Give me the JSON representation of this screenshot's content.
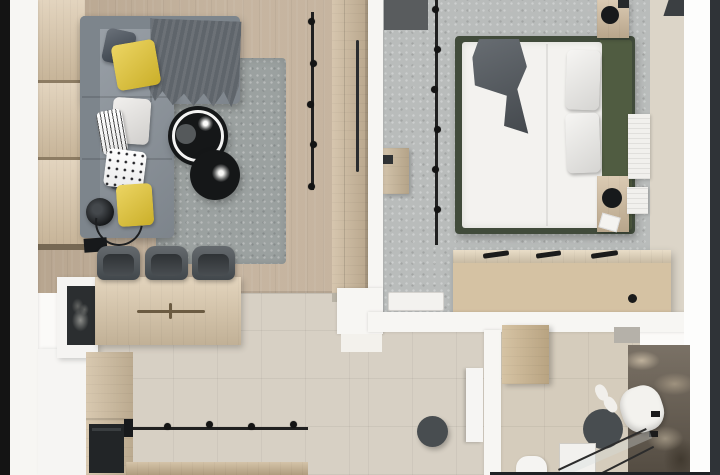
{
  "scene": {
    "kind": "apartment-interior-top-view-3d-render",
    "view": "top-down",
    "canvas": {
      "width": 720,
      "height": 475
    },
    "rooms": [
      {
        "id": "living-room",
        "floor": "light-oak-plank",
        "items": [
          "wood-slat-accent-wall",
          "corner-sofa",
          "throw-blanket",
          "area-rug",
          "coffee-table-pair",
          "floor-lamp",
          "ceiling-track-light",
          "wardrobe"
        ]
      },
      {
        "id": "bedroom",
        "floor": "gray-carpet",
        "items": [
          "double-bed",
          "green-headboard",
          "gray-blanket",
          "nightstand-pair",
          "table-lamps",
          "radiator",
          "wall-bench",
          "dresser",
          "ceiling-track-light"
        ]
      },
      {
        "id": "kitchen-dining",
        "floor": "beige-tile",
        "items": [
          "wall-desk",
          "office-chairs",
          "media-sideboard",
          "tall-cabinet",
          "oven",
          "counter",
          "ceiling-track-light"
        ]
      },
      {
        "id": "hallway",
        "floor": "beige-tile",
        "items": [
          "round-pouf",
          "wall-shelf"
        ]
      },
      {
        "id": "bathroom",
        "floor": "beige-tile",
        "items": [
          "floral-accent-wall",
          "open-wood-door",
          "shower-glass",
          "toilet",
          "round-rug",
          "towel",
          "slippers",
          "wall-hooks"
        ]
      }
    ],
    "counts": {
      "sofa_pillows": 7,
      "office_chairs": 3,
      "coffee_tables": 2,
      "nightstands": 2,
      "track_lights": 3,
      "dresser_handles": 3,
      "radiator_panels": 2
    }
  },
  "palette": {
    "frame_left": "#141414",
    "frame_right": "#2f3337",
    "wall": "#f7f6f3",
    "wall_bright": "#fdfdfc",
    "threshold": "#f3f1ec",
    "wood_floor": "#c2b09a",
    "wood_panel": "#d8c4a6",
    "panel_gap": "#8d7c63",
    "wardrobe": "#cdb99c",
    "wardrobe_base": "#b9b3a6",
    "sofa": "#8b939b",
    "sofa_dark": "#7d858c",
    "throw": "#5f656b",
    "pillow_yellow": "#e6c72f",
    "pillow_navy": "#39424d",
    "pillow_white": "#edebe8",
    "rug": "#9ba1a0",
    "table_black": "#151718",
    "ring_white": "#f4f4f3",
    "decor_gray": "#55595b",
    "lamp_black": "#17191b",
    "carpet": "#b9bcbb",
    "carpet_mat": "#595c5e",
    "bed_frame": "#414b3b",
    "headboard": "#505c41",
    "bedding": "#f3f2ef",
    "blanket": "#565c62",
    "nightstand": "#d1bc9e",
    "radiator": "#f1f0ed",
    "tv_dark": "#3b3f42",
    "dresser_top": "#e3d4b9",
    "dresser_front": "#d5c2a3",
    "handle_black": "#1b1b1b",
    "bedroom_wall": "#dcd5c8",
    "tile": "#d7d0c4",
    "bath_tile": "#d5ccbc",
    "pouf": "#484d50",
    "shelf_white": "#f6f5f3",
    "floral_wall": "#6b6154",
    "door_wood": "#cdb690",
    "toilet_white": "#f5f4f2",
    "towel_white": "#f3f2ee",
    "glass_line": "#2c2c2c",
    "column_white": "#f6f5f3",
    "sideboard_white": "#f5f4f2",
    "art_dark": "#2b2e30",
    "cabinet_wood": "#d0bd9f",
    "oven_black": "#222527",
    "counter_wood": "#c8b290",
    "desk_wood": "#dcc9ab",
    "groove_brown": "#6b5b42",
    "chair": "#4b5156",
    "chair_seat": "#3e4347",
    "track": "#202020",
    "bench_wood": "#c9b698",
    "tray_white": "#f3f2ef"
  }
}
